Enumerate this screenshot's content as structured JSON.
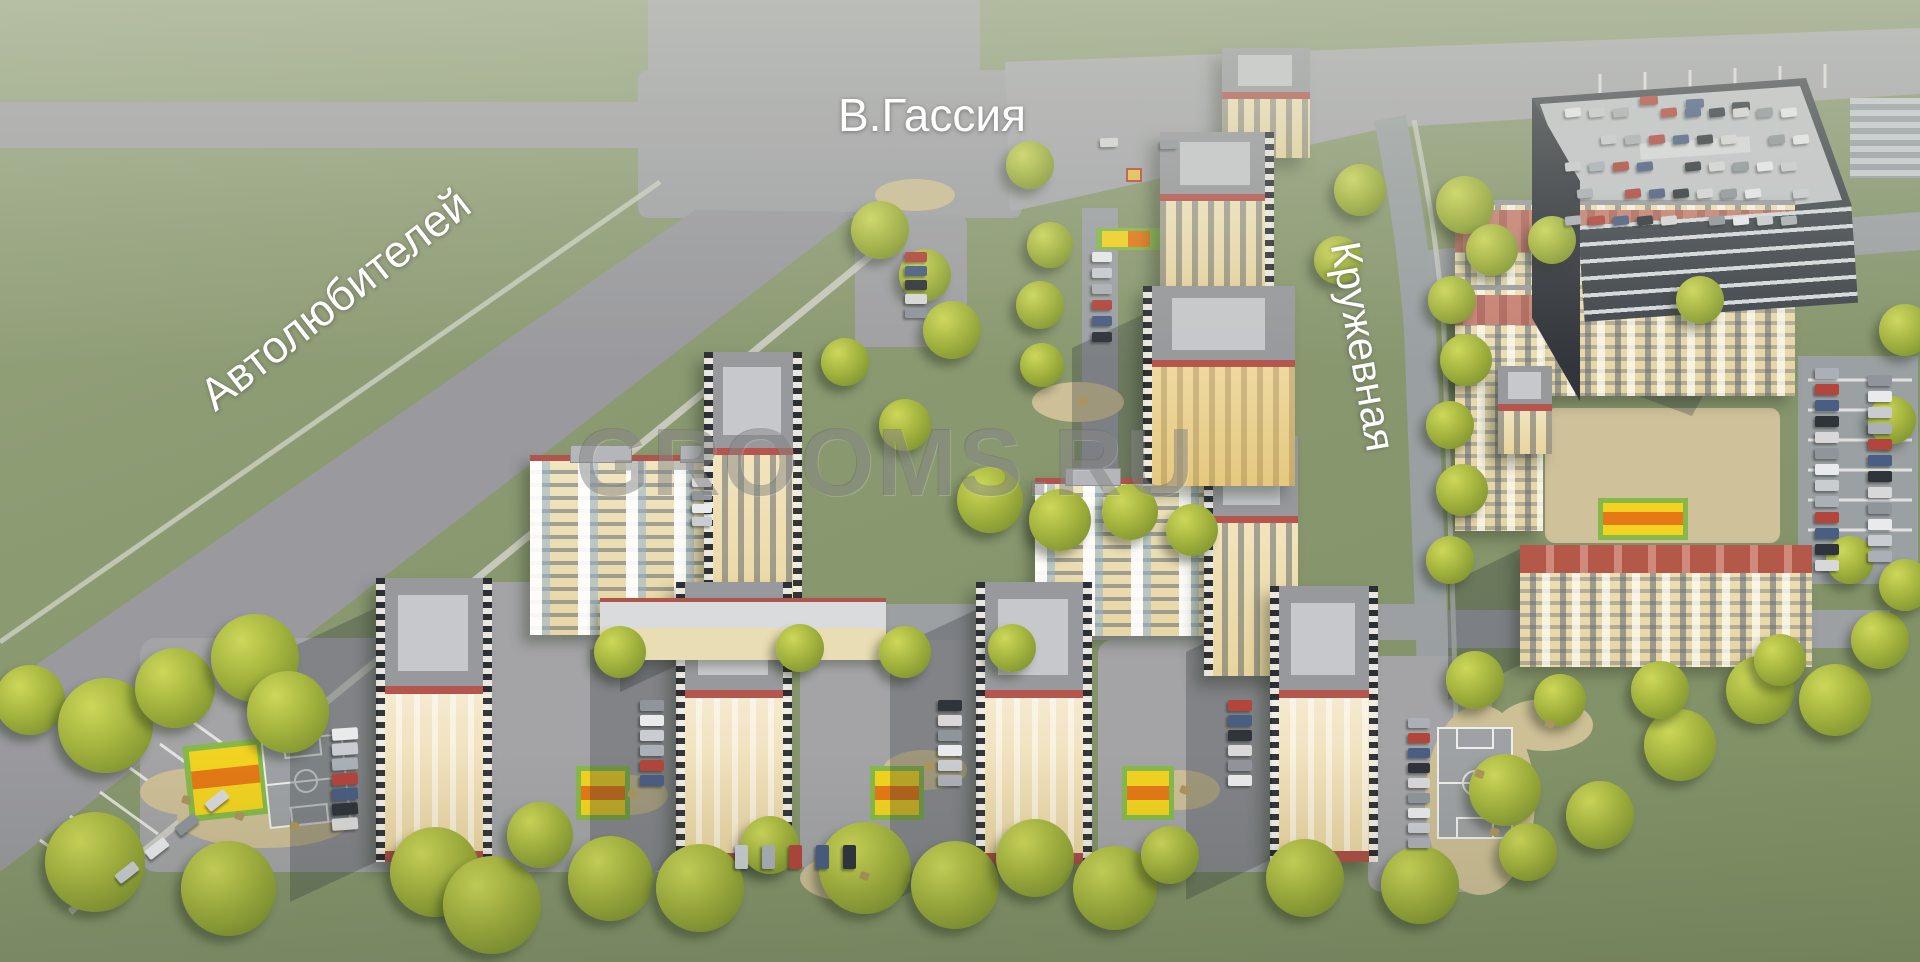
{
  "labels": {
    "street_top": "В.Гассия",
    "street_diagonal": "Автолюбителей",
    "street_right": "Кружевная"
  },
  "watermark": "GROOMS.RU",
  "colors": {
    "grass": "#8c9a72",
    "road": "#a0a0a4",
    "facade_cream": "#efe3bb",
    "roof_terracotta": "#b3584c",
    "roof_gray": "#9b9da0",
    "tree_green": "#a4b43e",
    "court_yellow": "#f2d321",
    "court_orange": "#e47916",
    "court_green_border": "#86b94a",
    "sand_tan": "#cdbf96",
    "label_color": "#ffffff"
  }
}
